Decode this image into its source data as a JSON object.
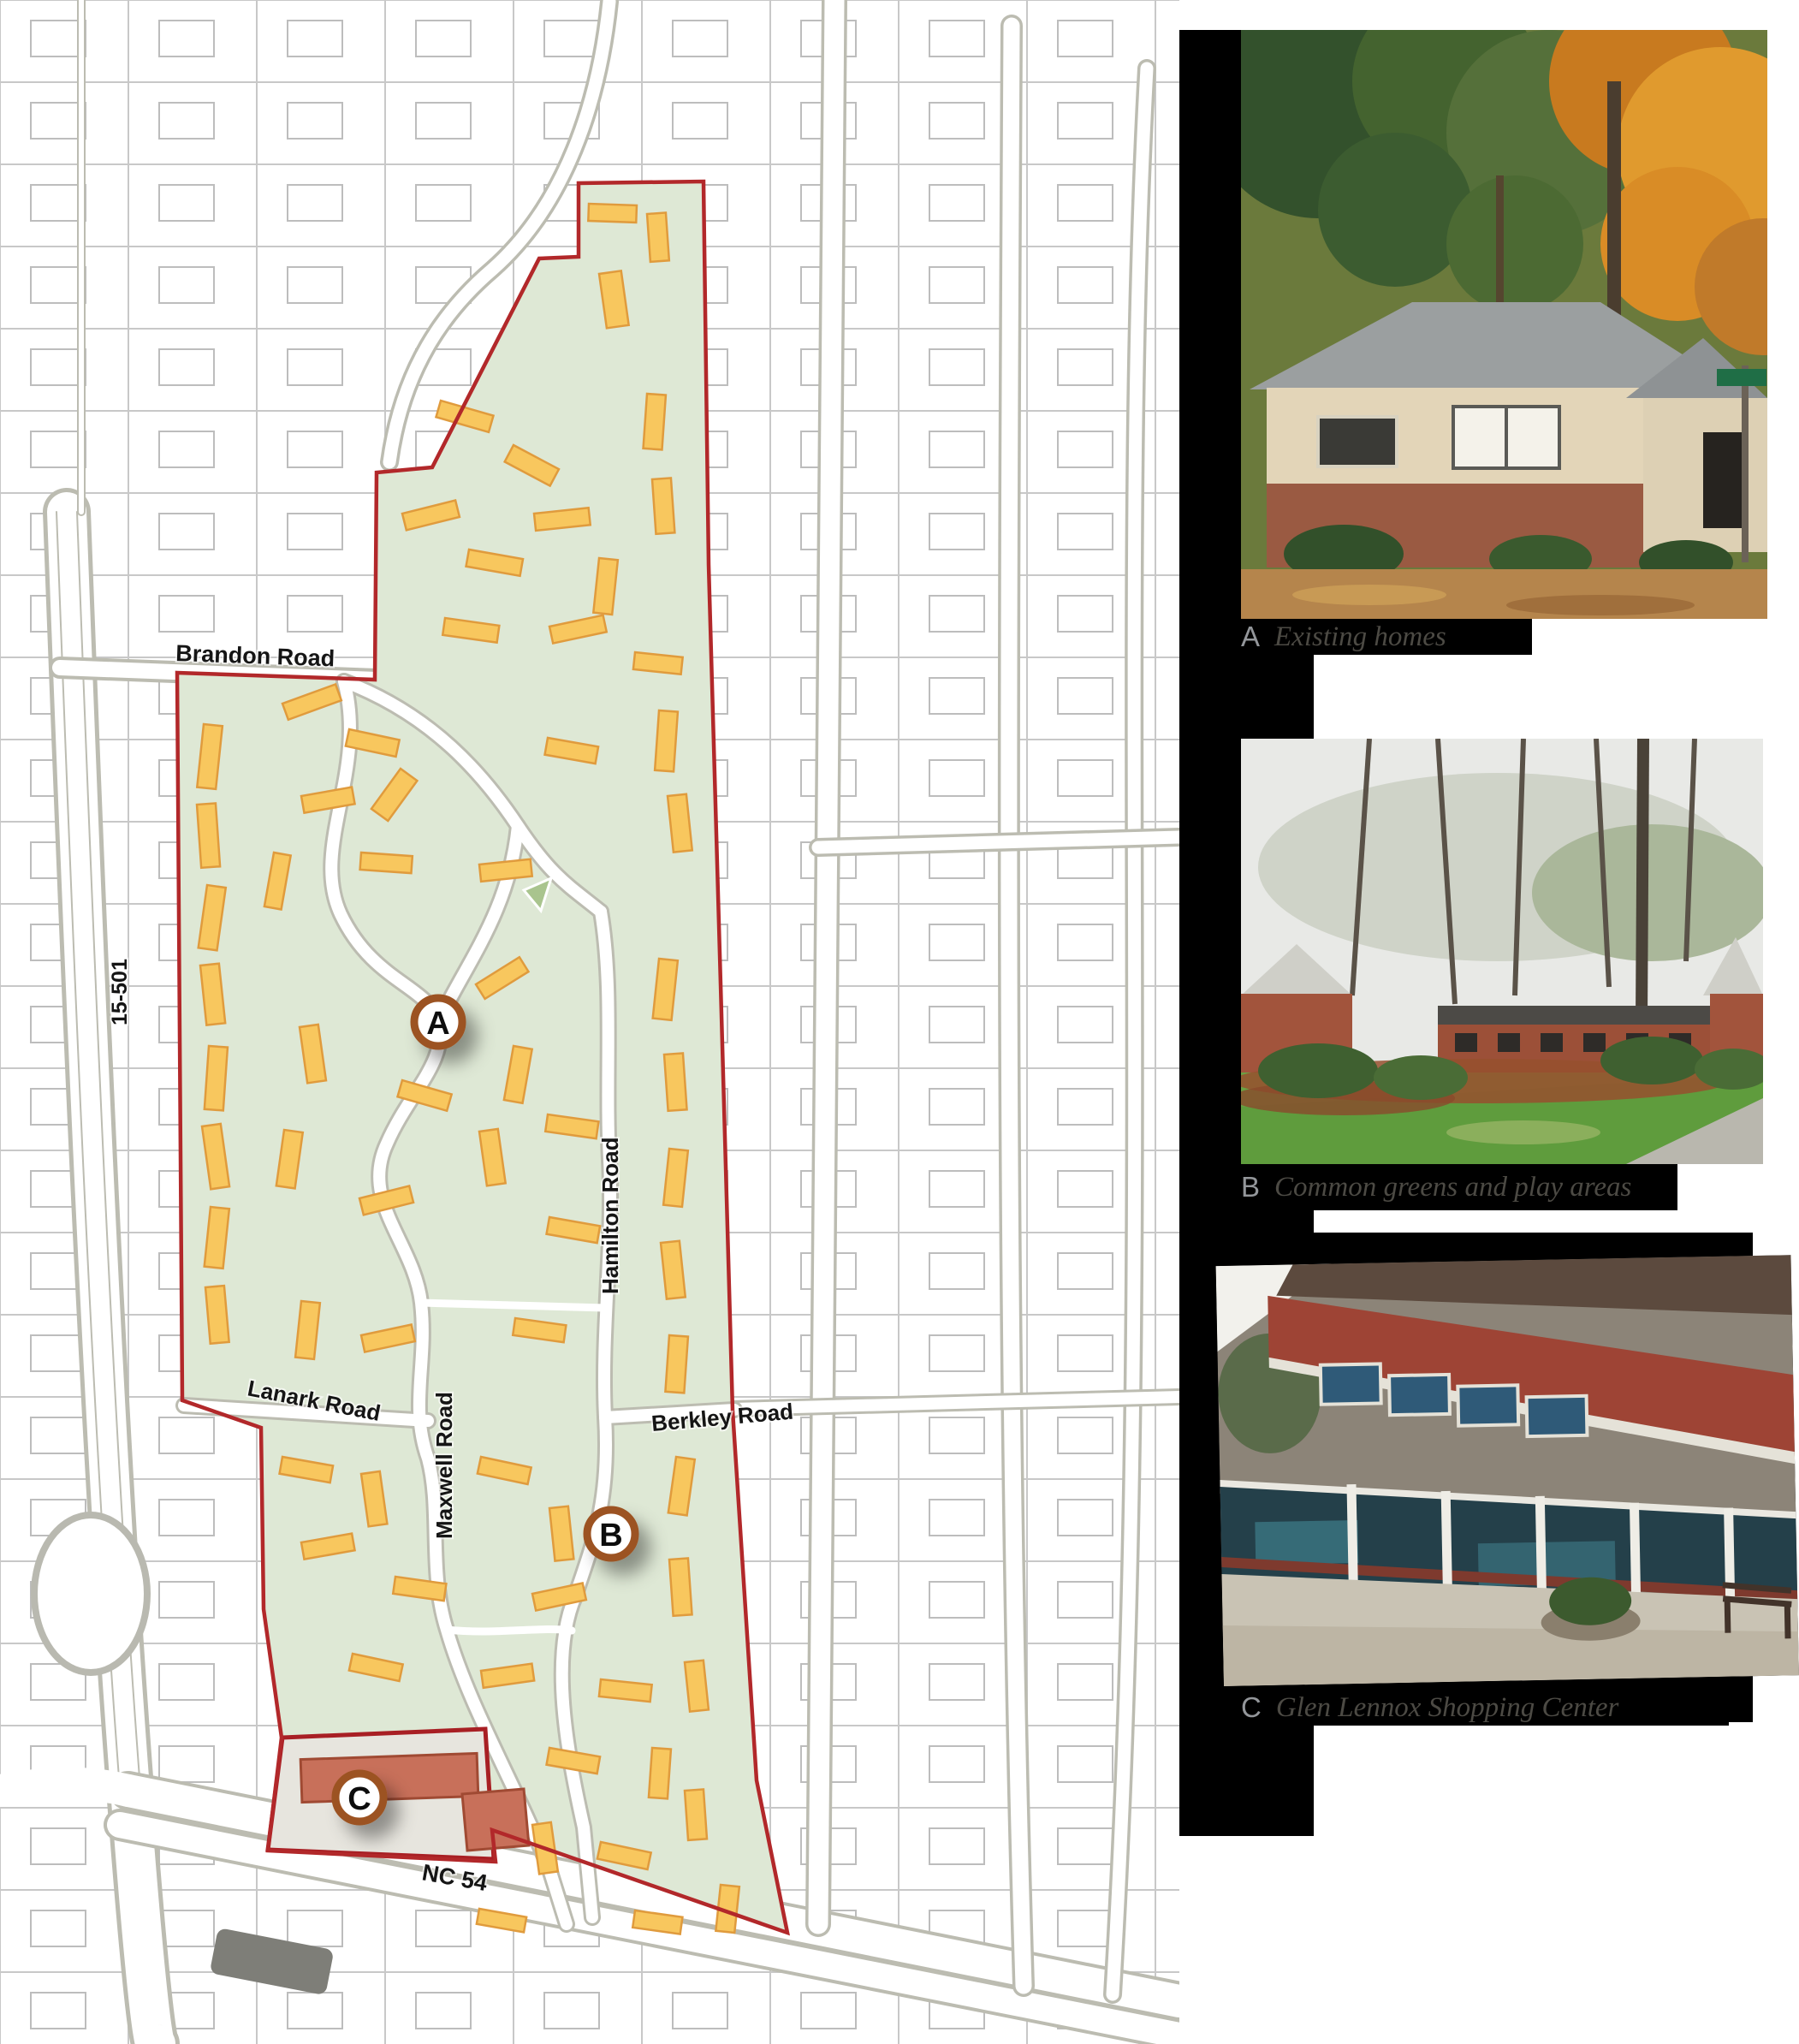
{
  "page": {
    "background": "#ffffff"
  },
  "map": {
    "title": "Glen Lennox neighborhood site map",
    "road_labels": {
      "brandon": "Brandon Road",
      "hwy_15_501": "15-501",
      "lanark": "Lanark Road",
      "maxwell": "Maxwell Road",
      "hamilton": "Hamilton Road",
      "berkley": "Berkley Road",
      "nc54": "NC 54"
    },
    "markers": [
      {
        "letter": "A"
      },
      {
        "letter": "B"
      },
      {
        "letter": "C"
      }
    ],
    "colors": {
      "site_fill": "#dee8d5",
      "site_boundary": "#b2282a",
      "building_fill": "#f8c75e",
      "building_outline": "#e09b3d",
      "shopping_building": "#c8705a",
      "shopping_parcel_outline": "#a81f24",
      "marker_ring": "#9c5220",
      "parcel_line": "#c8c8c8",
      "road_casing": "#b9b9b0"
    }
  },
  "photo_panel": {
    "photos": [
      {
        "letter": "A",
        "caption": "Existing homes"
      },
      {
        "letter": "B",
        "caption": "Common greens and play areas"
      },
      {
        "letter": "C",
        "caption": "Glen Lennox Shopping Center"
      }
    ]
  }
}
